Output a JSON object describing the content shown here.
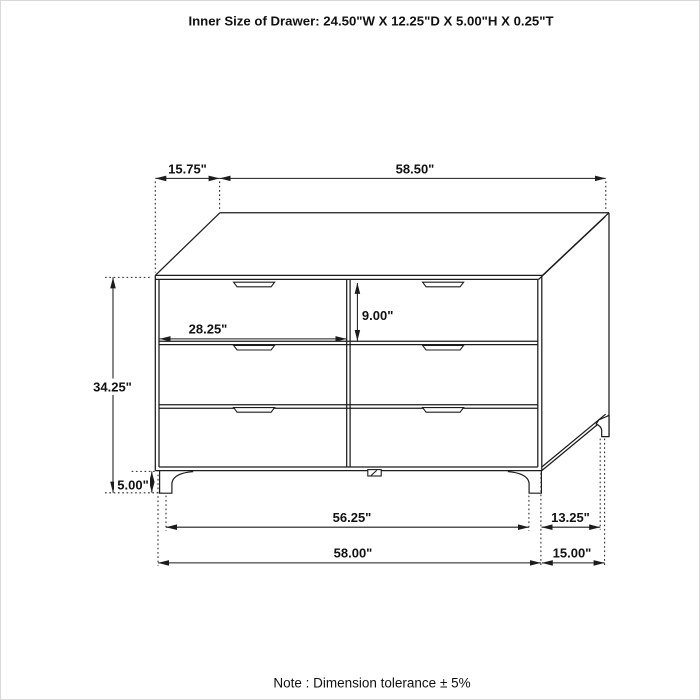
{
  "title": "Inner Size of Drawer: 24.50\"W X 12.25\"D X 5.00\"H X 0.25\"T",
  "note": "Note : Dimension tolerance  ± 5%",
  "dimensions": {
    "top_depth": "15.75\"",
    "top_width": "58.50\"",
    "drawer_front_width": "28.25\"",
    "drawer_front_height": "9.00\"",
    "overall_height": "34.25\"",
    "leg_height": "5.00\"",
    "base_inner_width": "56.25\"",
    "base_inner_depth": "13.25\"",
    "overall_width": "58.00\"",
    "overall_depth": "15.00\""
  },
  "colors": {
    "line": "#1c1c1c",
    "background": "#ffffff"
  }
}
